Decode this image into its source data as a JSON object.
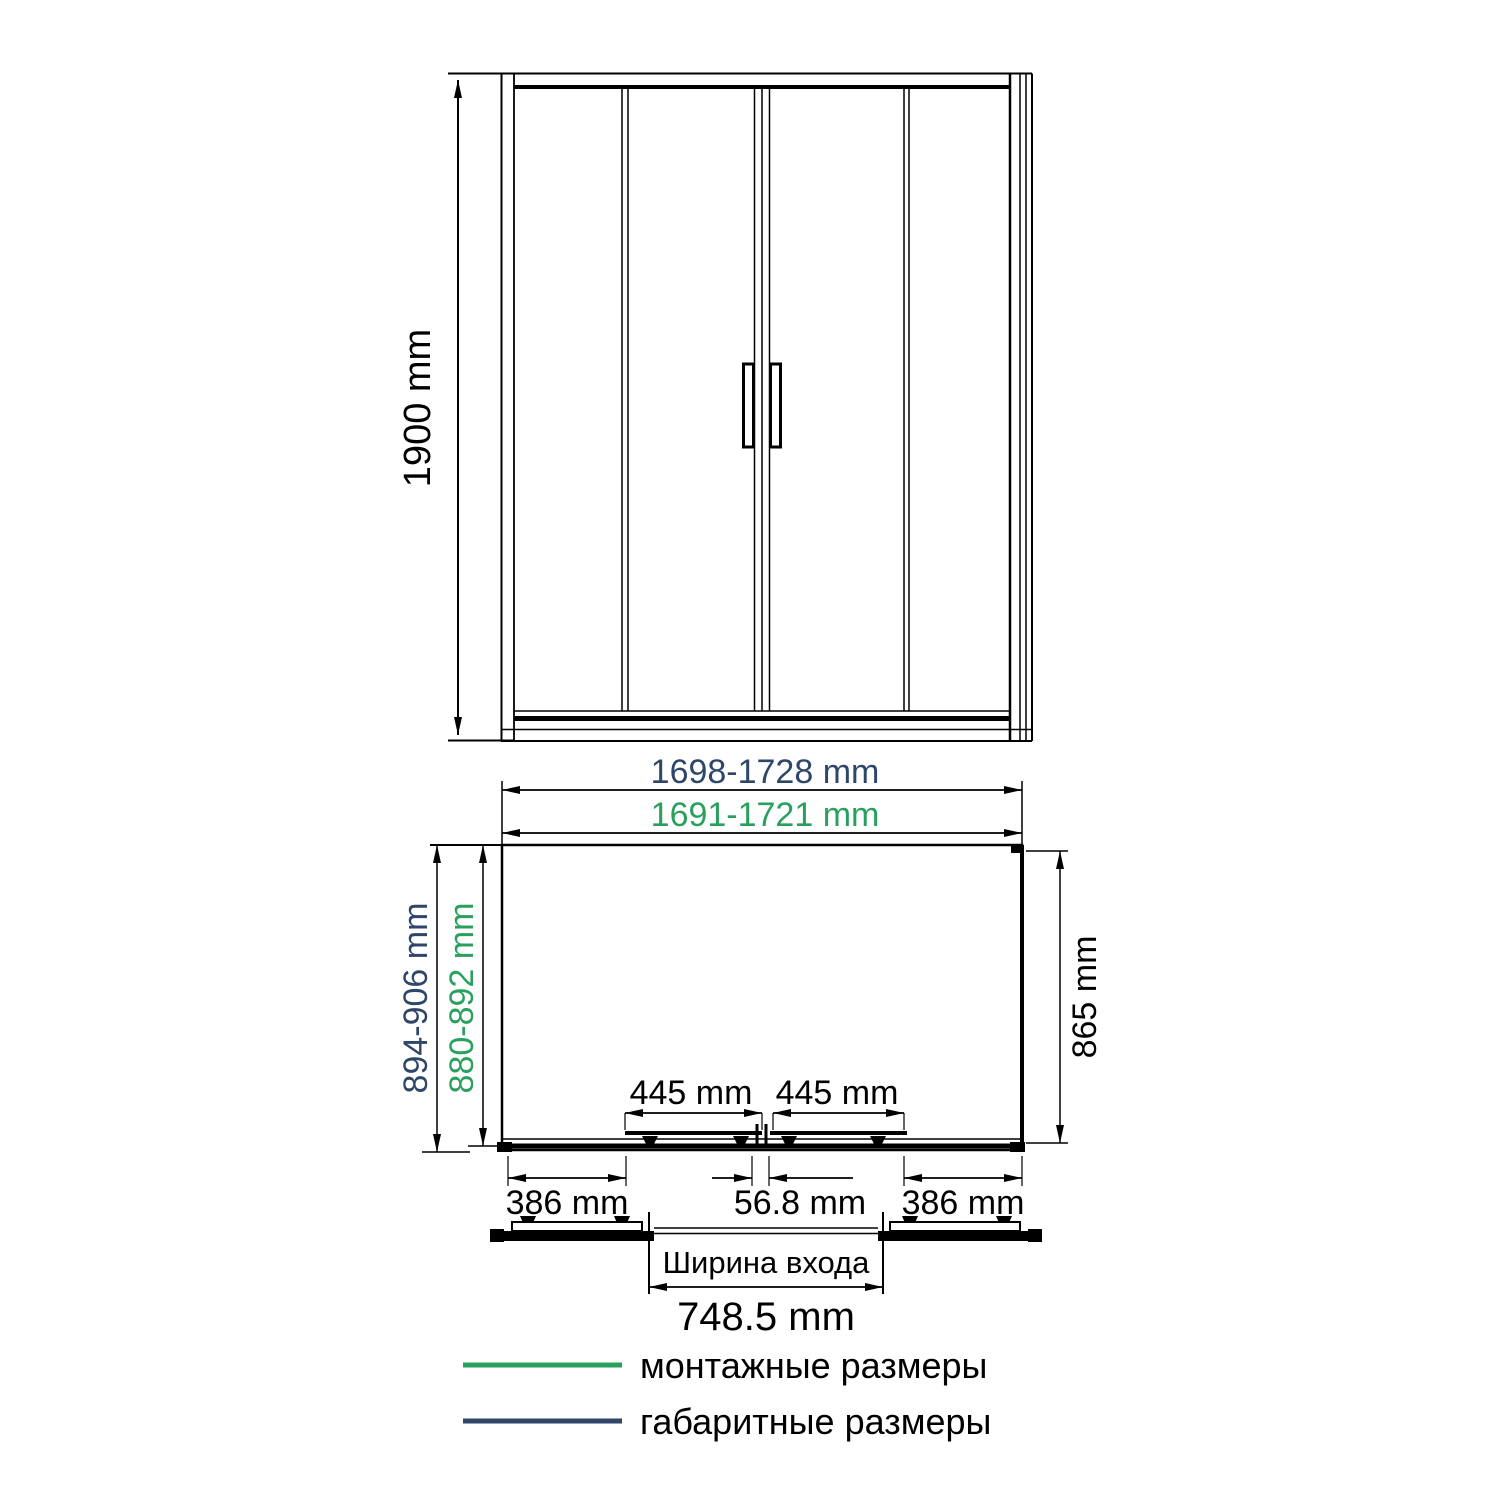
{
  "colors": {
    "mounting_green": "#2aa05e",
    "overall_navy": "#2e4668",
    "line_black": "#000000",
    "background": "#ffffff"
  },
  "elevation": {
    "height_dim": "1900 mm"
  },
  "plan": {
    "overall_width_dim": "1698-1728 mm",
    "mounting_width_dim": "1691-1721 mm",
    "overall_depth_dim": "894-906 mm",
    "mounting_depth_dim": "880-892 mm",
    "right_side_dim": "865 mm",
    "left_door_dim": "445 mm",
    "right_door_dim": "445 mm",
    "left_fixed_dim": "386 mm",
    "center_overlap_dim": "56.8 mm",
    "right_fixed_dim": "386 mm"
  },
  "entry": {
    "caption": "Ширина входа",
    "width_dim": "748.5 mm"
  },
  "legend": {
    "items": [
      {
        "swatch": "green",
        "label": "монтажные размеры"
      },
      {
        "swatch": "navy",
        "label": "габаритные размеры"
      }
    ]
  }
}
